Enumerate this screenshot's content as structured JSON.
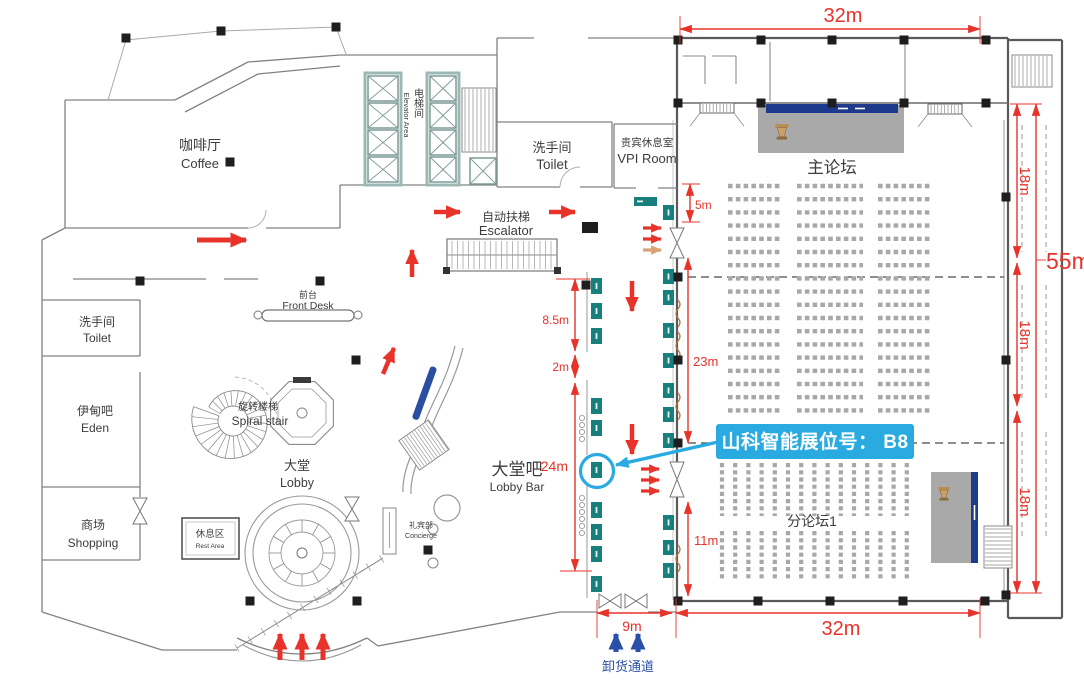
{
  "page": {
    "background": "#ffffff"
  },
  "colors": {
    "dimension_red": "#e8332a",
    "flow_arrow_red": "#e8332a",
    "flow_arrow_orange": "#dca277",
    "callout_blue": "#29abe2",
    "unloading_blue": "#2b4ea8",
    "booth_teal": "#17807c",
    "stage_gray": "#a9a9a9",
    "banner_navy": "#1e3a8c",
    "wall_gray": "#6f6f6f",
    "seat_gray": "#a8a8a8"
  },
  "rooms": {
    "coffee": {
      "zh": "咖啡厅",
      "en": "Coffee"
    },
    "toilet_west": {
      "zh": "洗手间",
      "en": "Toilet"
    },
    "eden_bar": {
      "zh": "伊甸吧",
      "en": "Eden"
    },
    "shopping": {
      "zh": "商场",
      "en": "Shopping"
    },
    "front_desk": {
      "zh": "前台",
      "en": "Front Desk"
    },
    "spiral_stair": {
      "zh": "旋转楼梯",
      "en": "Spiral stair"
    },
    "lobby": {
      "zh": "大堂",
      "en": "Lobby"
    },
    "rest_area": {
      "zh": "休息区",
      "en": "Rest Area"
    },
    "concierge": {
      "zh": "礼宾部",
      "en": "Concierge"
    },
    "escalator": {
      "zh": "自动扶梯",
      "en": "Escalator"
    },
    "elevator_area": {
      "zh": "电梯间",
      "en": "Elevator Area"
    },
    "toilet_center": {
      "zh": "洗手间",
      "en": "Toilet"
    },
    "vip_room": {
      "zh": "贵宾休息室",
      "en": "VPI Room"
    },
    "lobby_bar": {
      "zh": "大堂吧",
      "en": "Lobby Bar"
    },
    "main_forum": {
      "zh": "主论坛"
    },
    "sub_forum_1": {
      "zh": "分论坛1"
    },
    "unloading_channel": {
      "zh": "卸货通道"
    }
  },
  "dimensions": {
    "hall_width_top": "32m",
    "hall_width_bottom": "32m",
    "hall_depth_total": "55m",
    "bay_top": "18m",
    "bay_middle": "18m",
    "bay_bottom": "18m",
    "gap_top": "5m",
    "booth_run_upper": "23m",
    "booth_run_lower": "11m",
    "aisle_upper": "8.5m",
    "aisle_gap": "2m",
    "lobby_bar_run": "24m",
    "unload_door": "9m"
  },
  "callout": {
    "text": "山科智能展位号： B8",
    "booth": "B8"
  }
}
